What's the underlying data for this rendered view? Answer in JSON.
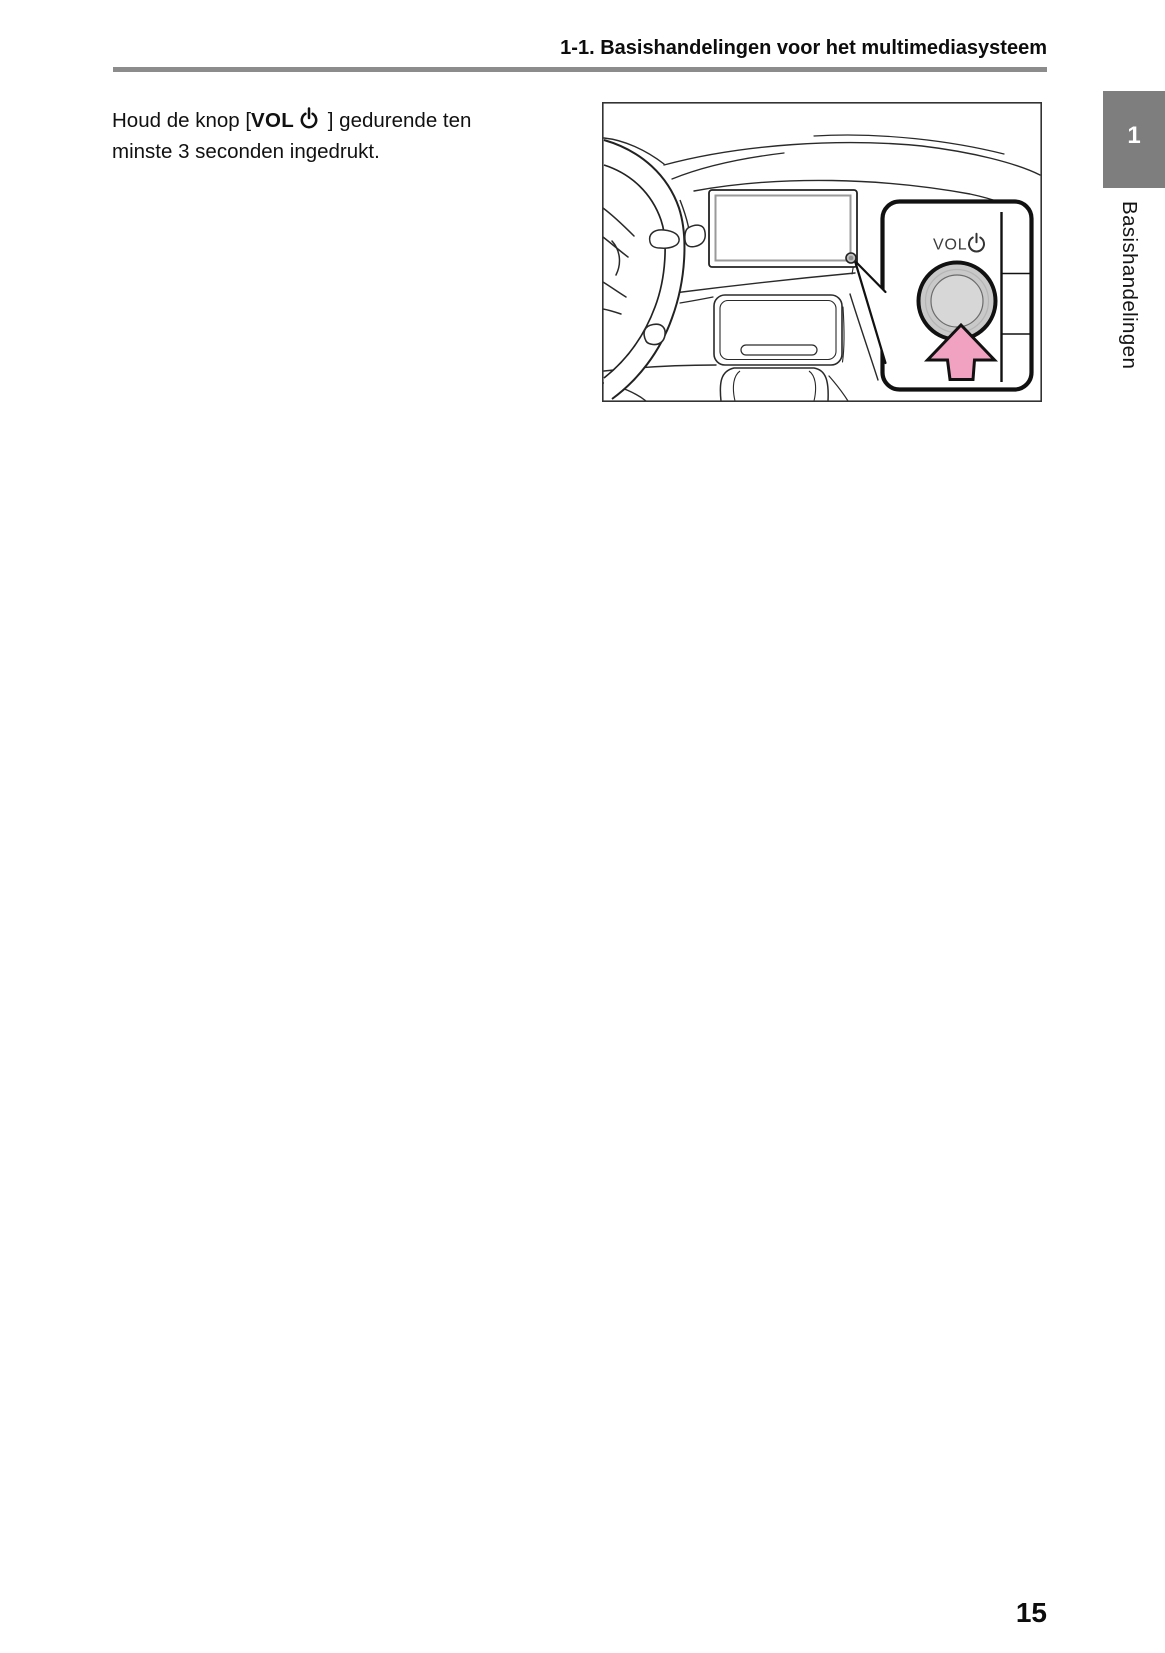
{
  "header": {
    "section_title": "1-1. Basishandelingen voor het multimediasysteem"
  },
  "instruction": {
    "line1_prefix": "Houd de knop [",
    "button_label": "VOL",
    "power_icon": "power-icon",
    "line1_suffix": " ] gedurende ten",
    "line2": "minste 3 seconden ingedrukt."
  },
  "figure": {
    "callout": {
      "knob_label": "VOL",
      "power_icon": "power-icon",
      "arrow_icon": "press-up-arrow-icon"
    }
  },
  "sidebar": {
    "chapter_tab": "1",
    "chapter_title": "Basishandelingen"
  },
  "footer": {
    "page_number": "15"
  },
  "colors": {
    "arrow_pink": "#f2a2c1",
    "knob_gray": "#c9c9c9",
    "knob_inner_gray": "#d7d7d7",
    "chapter_tab_gray": "#7e7e7e",
    "rule_gray": "#8c8c8c"
  }
}
